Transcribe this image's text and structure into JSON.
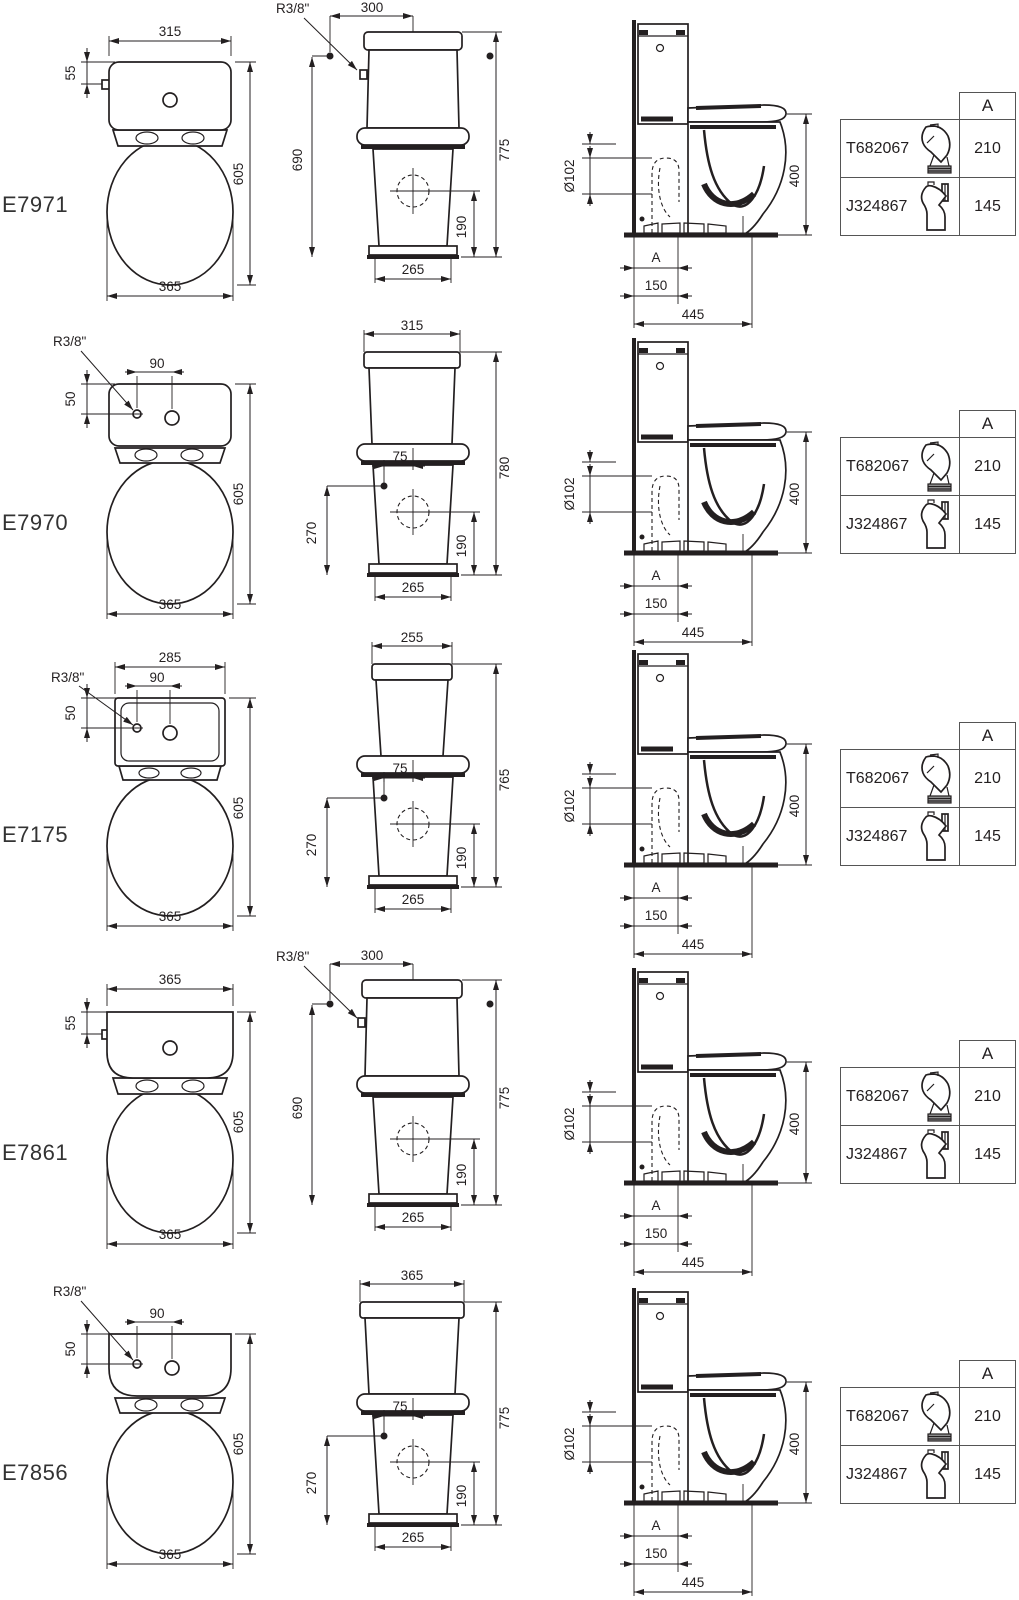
{
  "ink": "#231f20",
  "background": "#ffffff",
  "models": [
    {
      "id": "E7971",
      "front": {
        "top": "315",
        "left_small": "55",
        "right": "605",
        "bottom": "365"
      },
      "middle": {
        "fitting": "R3/8\"",
        "top": "300",
        "left": "690",
        "right": "775",
        "inner": "190",
        "bottom": "265"
      },
      "side": {
        "diameter": "Ø102",
        "a": "A",
        "offset": "150",
        "depth": "445",
        "height": "400"
      },
      "table": {
        "header": "A",
        "rows": [
          {
            "code": "T682067",
            "value": "210"
          },
          {
            "code": "J324867",
            "value": "145"
          }
        ]
      }
    },
    {
      "id": "E7970",
      "front": {
        "fitting": "R3/8\"",
        "hole_offset": "90",
        "left_small": "50",
        "right": "605",
        "bottom": "365"
      },
      "middle": {
        "top": "315",
        "seat_offset": "75",
        "left": "270",
        "right": "780",
        "inner": "190",
        "bottom": "265"
      },
      "side": {
        "diameter": "Ø102",
        "a": "A",
        "offset": "150",
        "depth": "445",
        "height": "400"
      },
      "table": {
        "header": "A",
        "rows": [
          {
            "code": "T682067",
            "value": "210"
          },
          {
            "code": "J324867",
            "value": "145"
          }
        ]
      }
    },
    {
      "id": "E7175",
      "front": {
        "top": "285",
        "fitting": "R3/8\"",
        "hole_offset": "90",
        "left_small": "50",
        "right": "605",
        "bottom": "365"
      },
      "middle": {
        "top": "255",
        "seat_offset": "75",
        "left": "270",
        "right": "765",
        "inner": "190",
        "bottom": "265"
      },
      "side": {
        "diameter": "Ø102",
        "a": "A",
        "offset": "150",
        "depth": "445",
        "height": "400"
      },
      "table": {
        "header": "A",
        "rows": [
          {
            "code": "T682067",
            "value": "210"
          },
          {
            "code": "J324867",
            "value": "145"
          }
        ]
      }
    },
    {
      "id": "E7861",
      "front": {
        "top": "365",
        "left_small": "55",
        "right": "605",
        "bottom": "365"
      },
      "middle": {
        "fitting": "R3/8\"",
        "top": "300",
        "left": "690",
        "right": "775",
        "inner": "190",
        "bottom": "265"
      },
      "side": {
        "diameter": "Ø102",
        "a": "A",
        "offset": "150",
        "depth": "445",
        "height": "400"
      },
      "table": {
        "header": "A",
        "rows": [
          {
            "code": "T682067",
            "value": "210"
          },
          {
            "code": "J324867",
            "value": "145"
          }
        ]
      }
    },
    {
      "id": "E7856",
      "front": {
        "fitting": "R3/8\"",
        "hole_offset": "90",
        "left_small": "50",
        "right": "605",
        "bottom": "365"
      },
      "middle": {
        "top": "365",
        "seat_offset": "75",
        "left": "270",
        "right": "775",
        "inner": "190",
        "bottom": "265"
      },
      "side": {
        "diameter": "Ø102",
        "a": "A",
        "offset": "150",
        "depth": "445",
        "height": "400"
      },
      "table": {
        "header": "A",
        "rows": [
          {
            "code": "T682067",
            "value": "210"
          },
          {
            "code": "J324867",
            "value": "145"
          }
        ]
      }
    }
  ]
}
